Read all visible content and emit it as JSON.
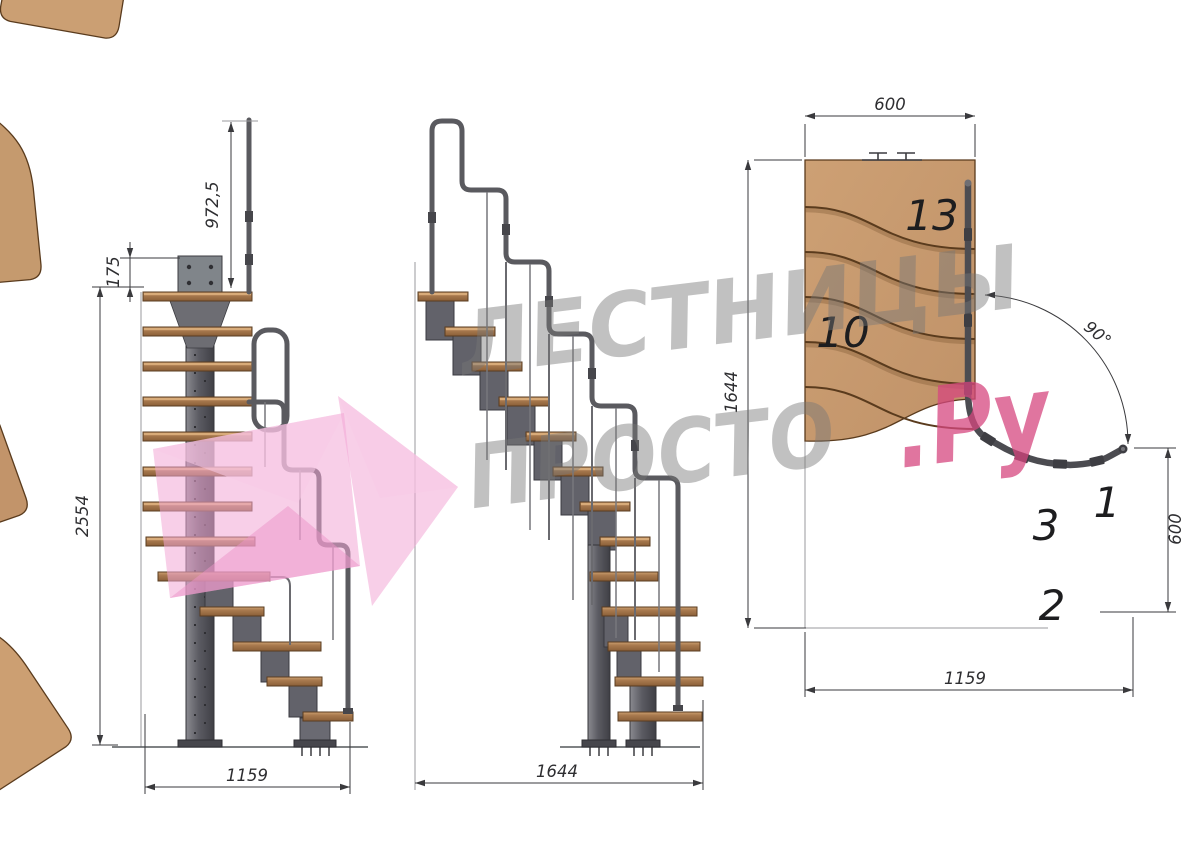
{
  "page": {
    "background": "#ffffff"
  },
  "watermark": {
    "line1": "ЛЕСТНИЦЫ",
    "line2": "ПРОСТО",
    "suffix": ".Ру",
    "text_color": "#777777",
    "accent_color": "#d6477f",
    "arrow_color": "#f2a8d5"
  },
  "side_view": {
    "dim_handrail_height": "972,5",
    "dim_mount_height": "175",
    "dim_total_height": "2554",
    "dim_footprint": "1159"
  },
  "front_view": {
    "dim_footprint": "1644"
  },
  "plan_view": {
    "dim_top_width": "600",
    "dim_depth": "1644",
    "dim_angle": "90°",
    "dim_right_width": "600",
    "dim_bottom_width": "1159",
    "labels": {
      "tread13": "13",
      "tread10": "10",
      "tread3": "3",
      "tread1": "1",
      "tread2": "2"
    }
  },
  "colors": {
    "wood_top": "#c89c70",
    "wood_side": "#aa7b4f",
    "metal": "#62626a",
    "metal_dark": "#3c3c41",
    "dim_line": "#3a3a3d"
  }
}
